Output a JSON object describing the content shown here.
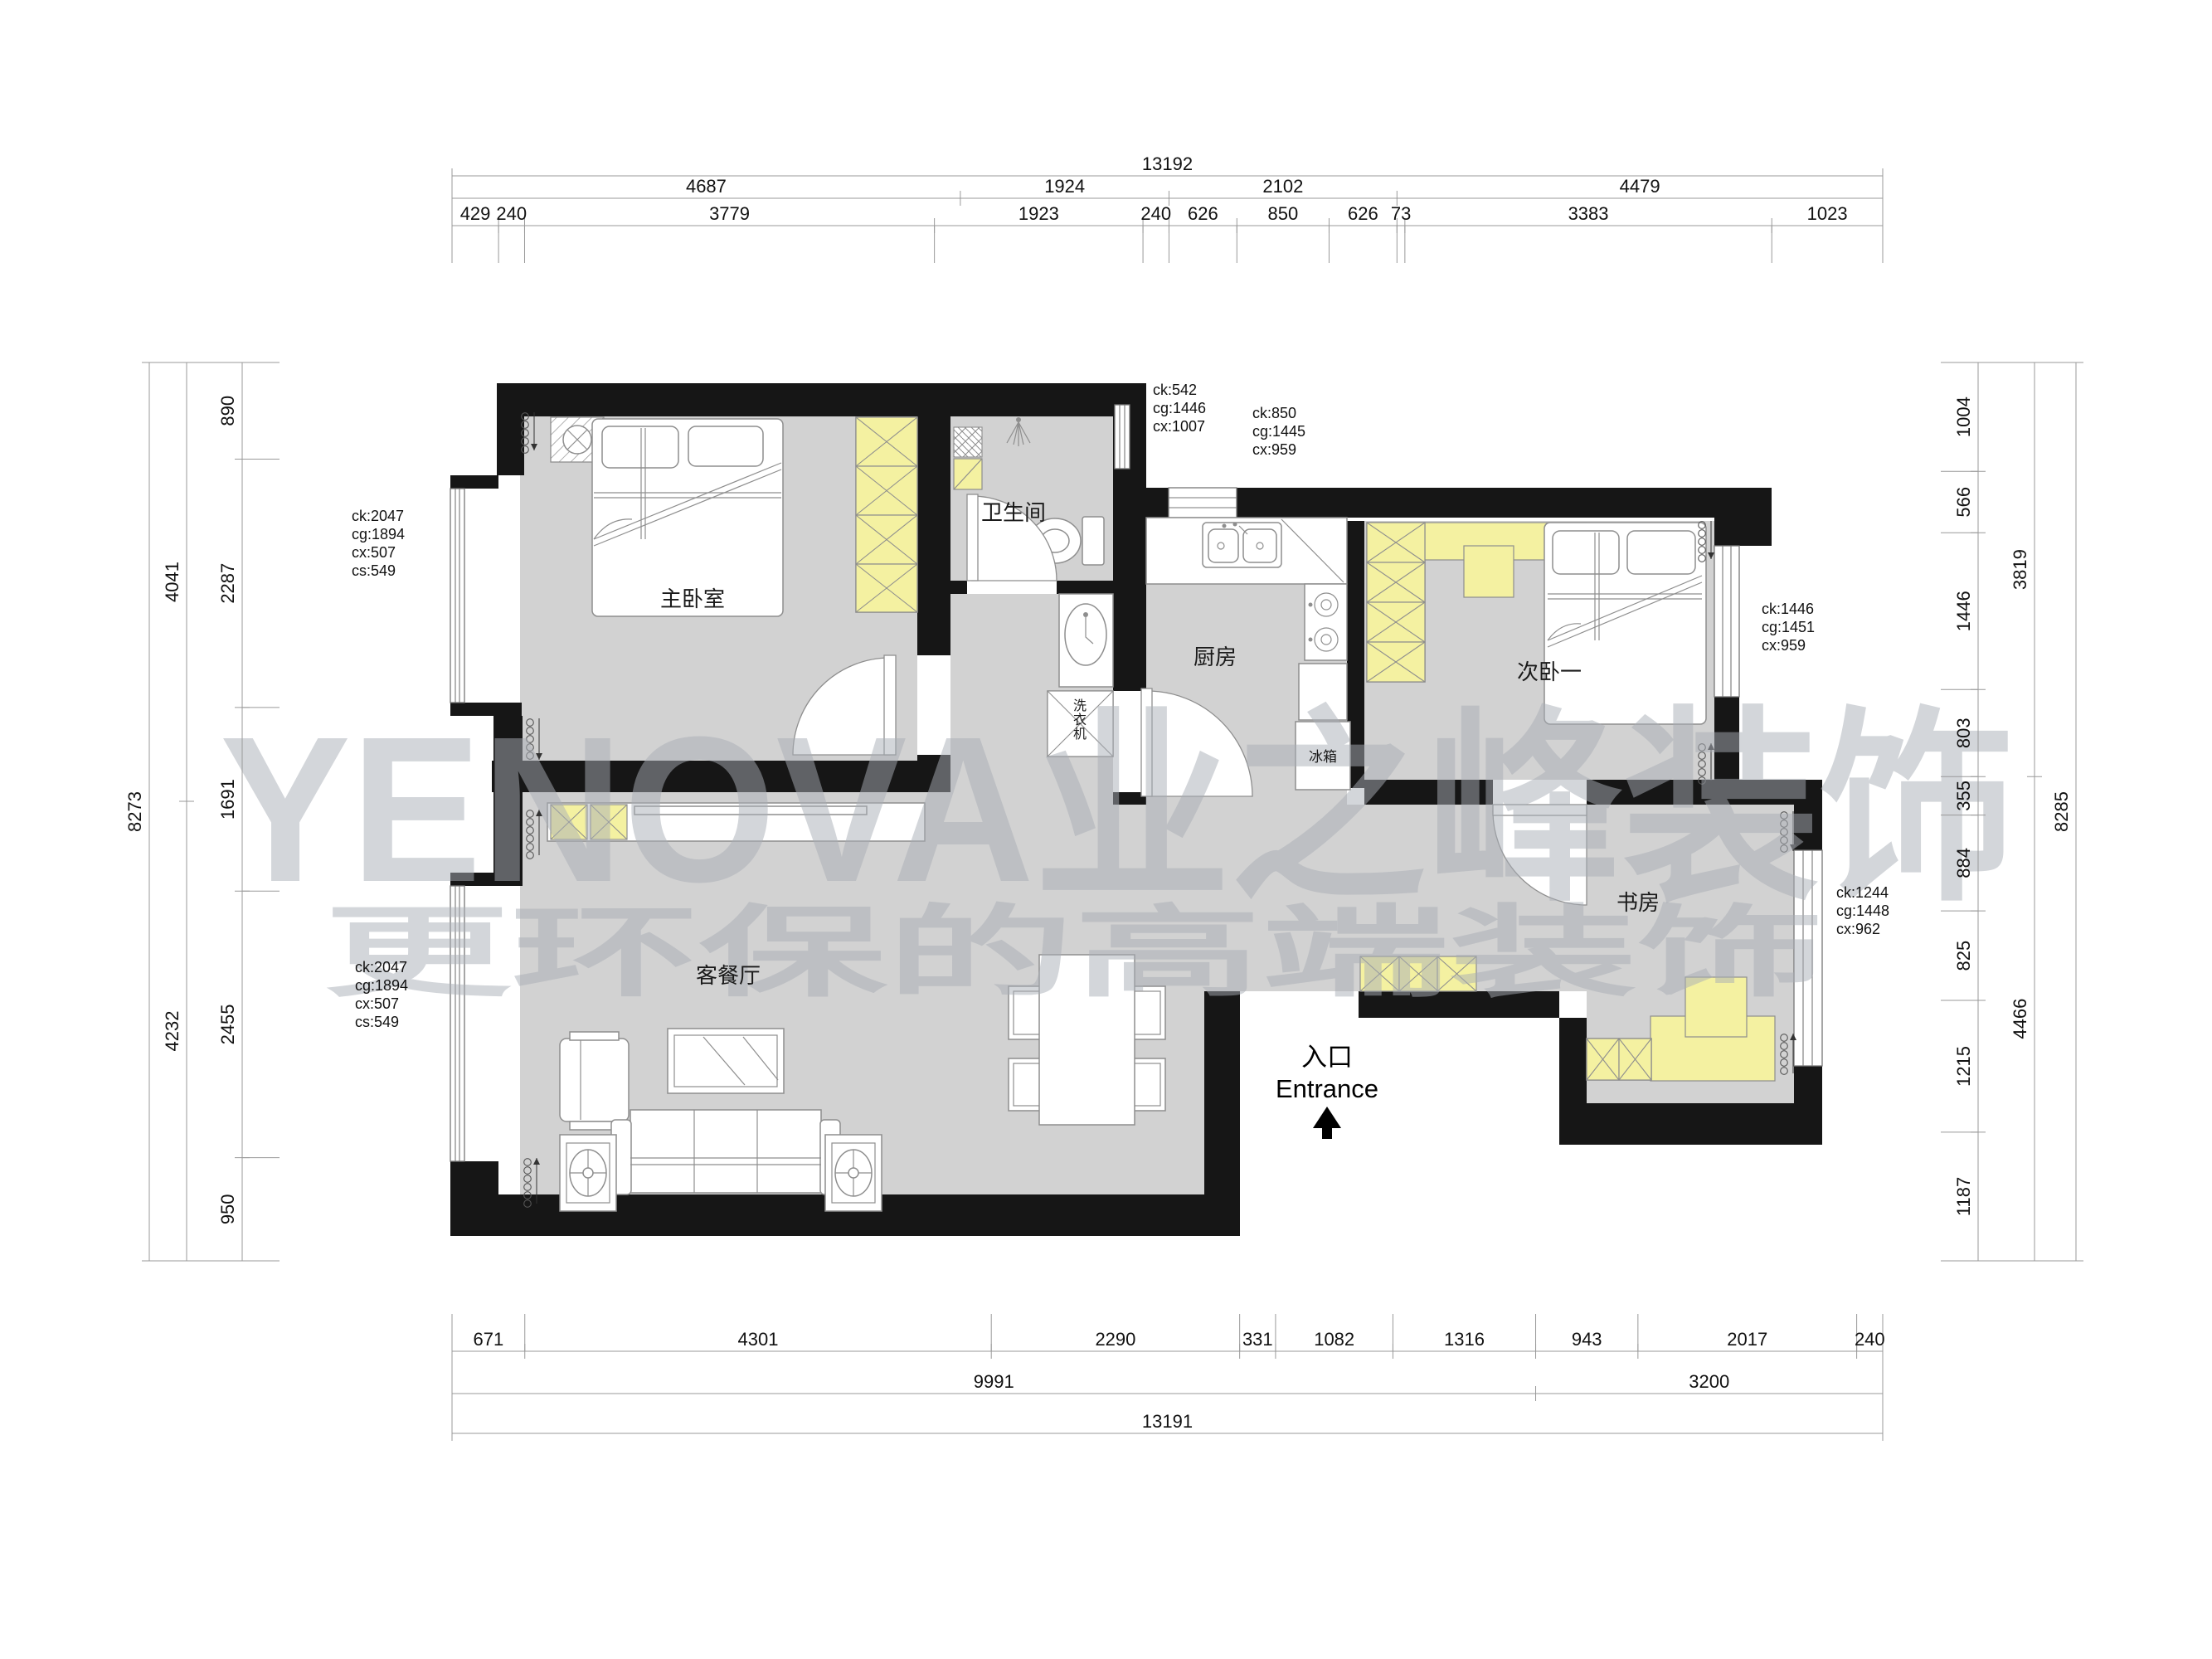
{
  "watermark": {
    "line1": "YENOVA业之峰装饰",
    "line2": "更环保的高端装饰"
  },
  "rooms": {
    "master_bedroom": "主卧室",
    "bathroom": "卫生间",
    "kitchen": "厨房",
    "second_bedroom": "次卧一",
    "study": "书房",
    "living_dining": "客餐厅",
    "fridge": "冰箱",
    "washing_machine": "洗衣机"
  },
  "entrance": {
    "cn": "入口",
    "en": "Entrance"
  },
  "annotations": {
    "master_left": [
      "ck:2047",
      "cg:1894",
      "cx:507",
      "cs:549"
    ],
    "living_left": [
      "ck:2047",
      "cg:1894",
      "cx:507",
      "cs:549"
    ],
    "bath_top": [
      "ck:542",
      "cg:1446",
      "cx:1007"
    ],
    "kitchen_top": [
      "ck:850",
      "cg:1445",
      "cx:959"
    ],
    "second_bedroom_right": [
      "ck:1446",
      "cg:1451",
      "cx:959"
    ],
    "study_right": [
      "ck:1244",
      "cg:1448",
      "cx:962"
    ]
  },
  "dimensions": {
    "top": {
      "row1": [
        "13192"
      ],
      "row2": [
        "4687",
        "1924",
        "2102",
        "4479"
      ],
      "row3": [
        "429",
        "240",
        "3779",
        "1923",
        "240",
        "626",
        "850",
        "626",
        "73",
        "3383",
        "1023"
      ]
    },
    "bottom": {
      "row1": [
        "671",
        "4301",
        "2290",
        "331",
        "1082",
        "1316",
        "943",
        "2017",
        "240"
      ],
      "row2": [
        "9991",
        "3200"
      ],
      "row3": [
        "13191"
      ]
    },
    "left": {
      "outer": [
        "8273"
      ],
      "mid": [
        "4041",
        "4232"
      ],
      "inner": [
        "890",
        "2287",
        "1691",
        "2455",
        "950"
      ]
    },
    "right": {
      "outer": [
        "8285"
      ],
      "mid": [
        "3819",
        "4466"
      ],
      "inner": [
        "1004",
        "566",
        "1446",
        "803",
        "355",
        "884",
        "825",
        "1215",
        "1187"
      ]
    }
  },
  "colors": {
    "wall": "#161616",
    "floor": "#d2d2d2",
    "accent_yellow": "#f4f1a1",
    "watermark": "#a9aeb6"
  }
}
